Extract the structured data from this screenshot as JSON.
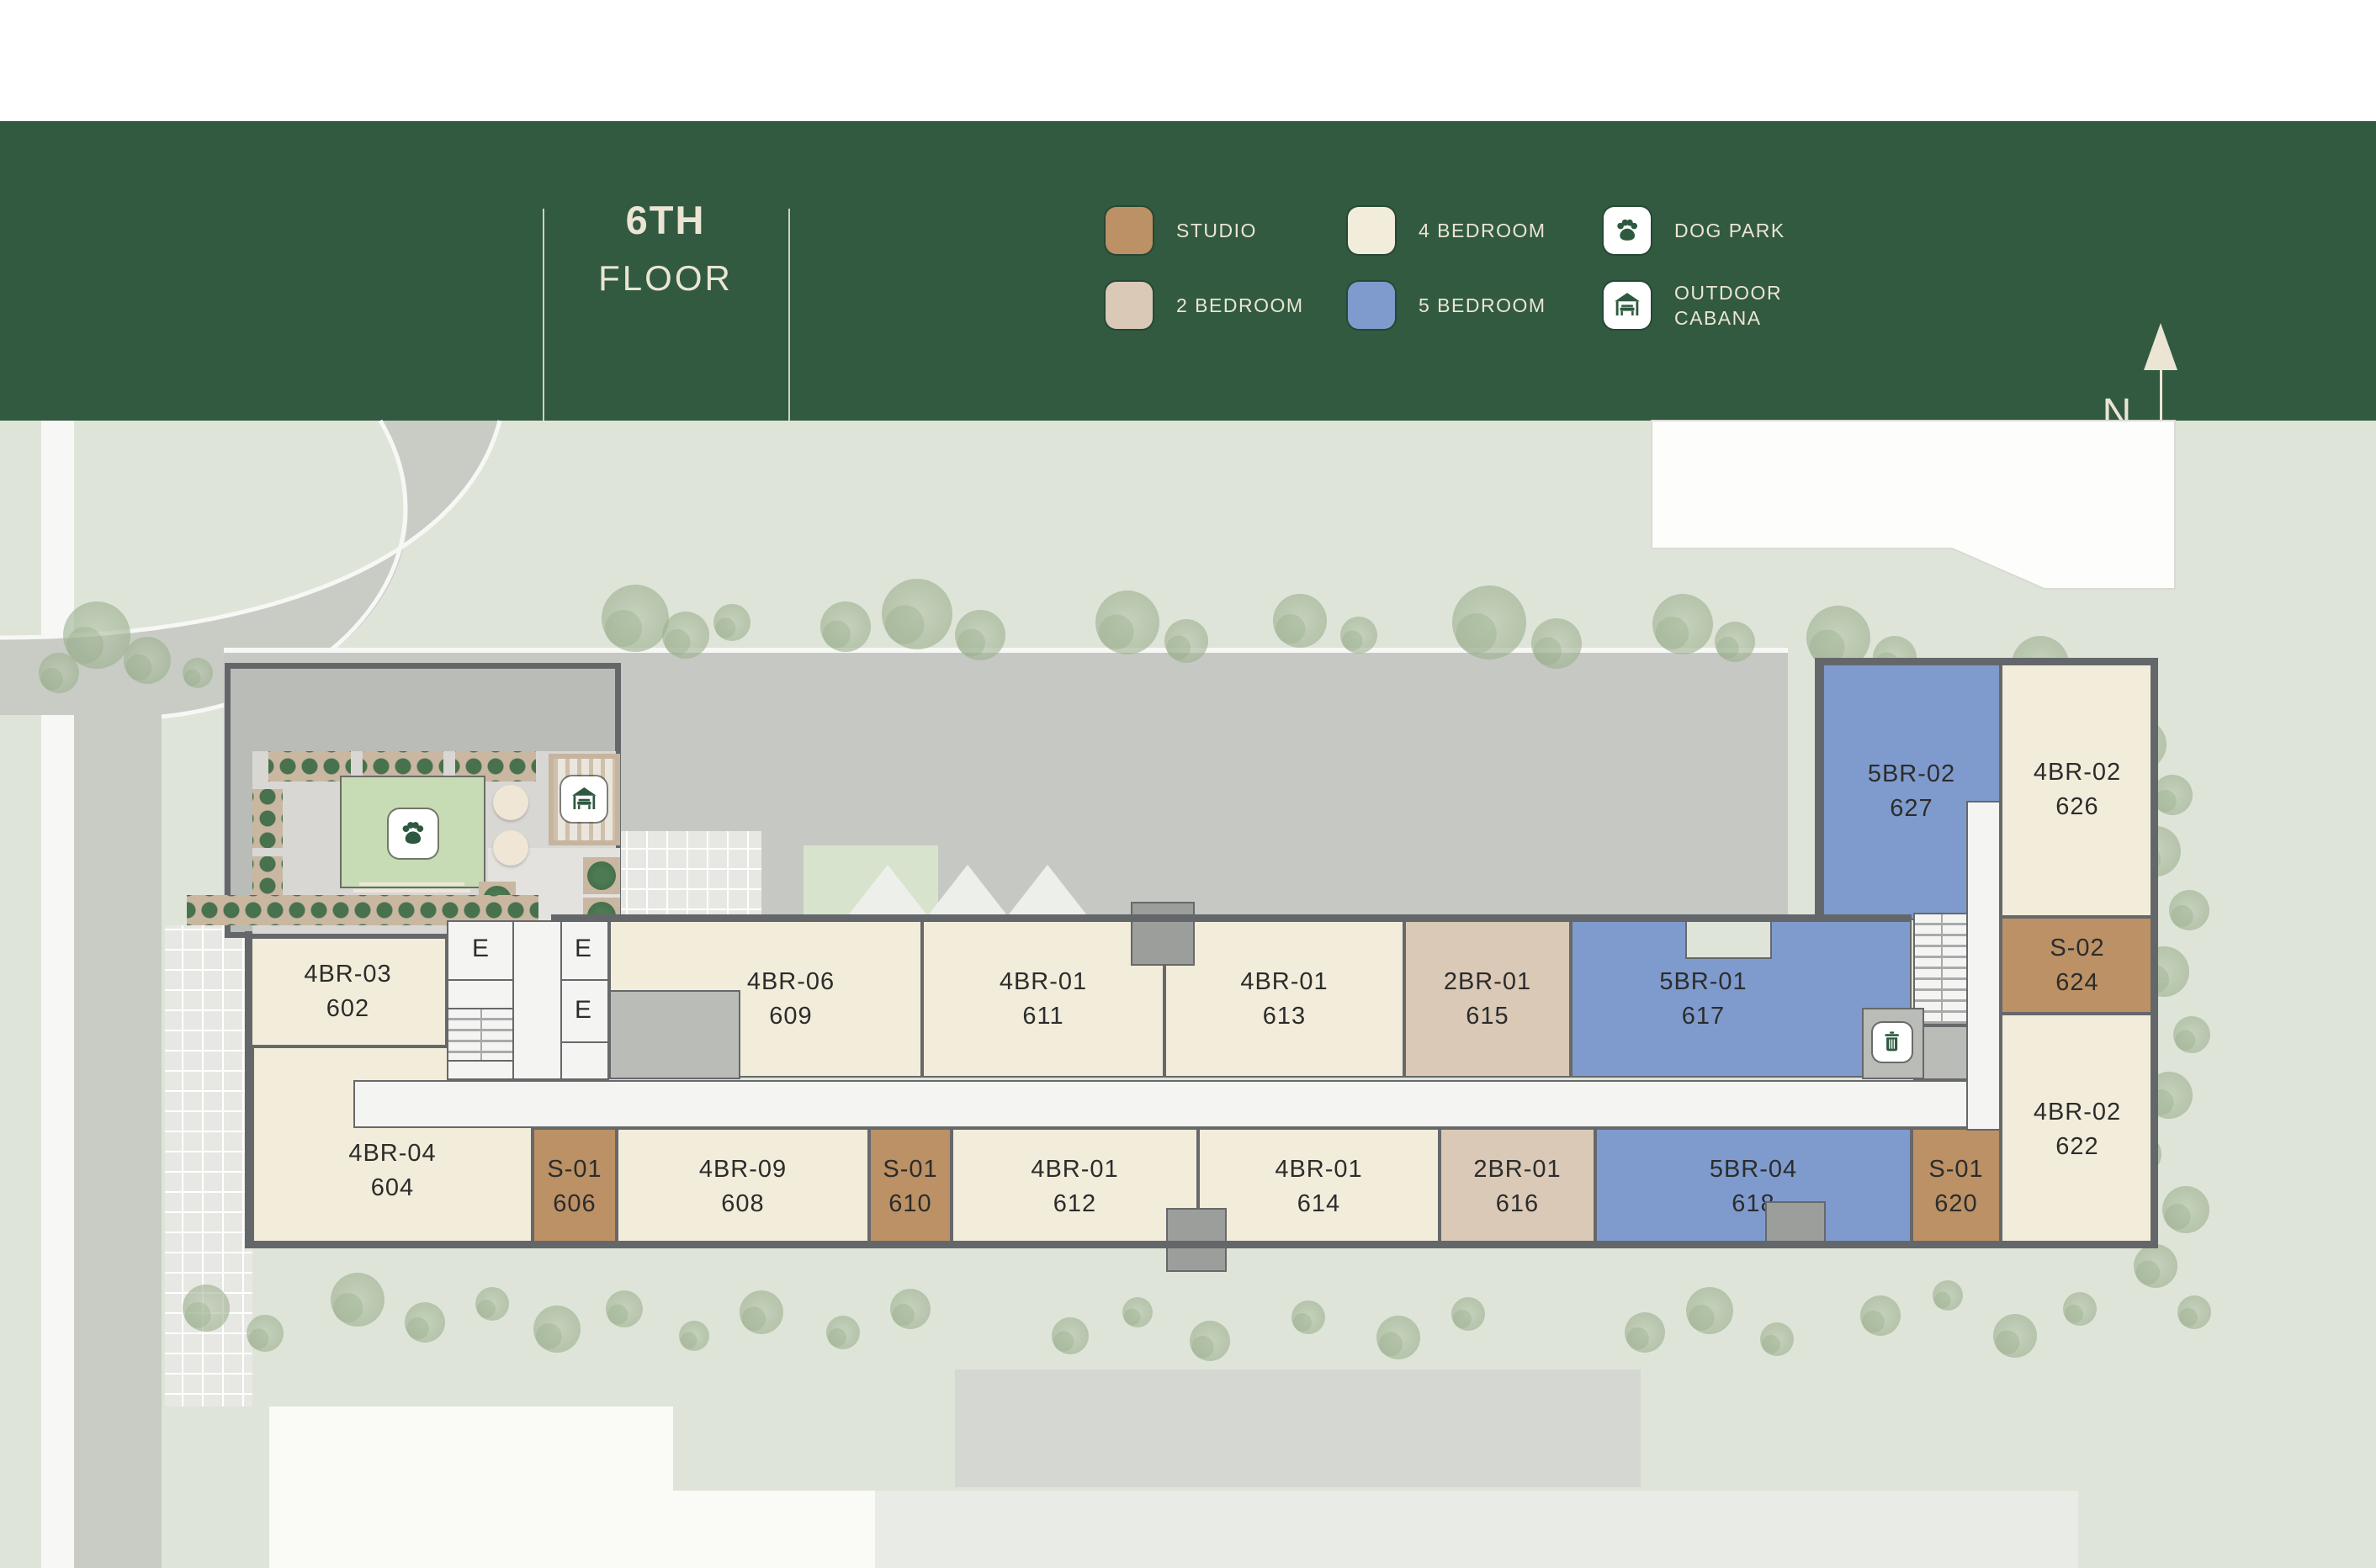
{
  "header": {
    "floor_number": "6TH",
    "floor_label": "FLOOR"
  },
  "legend": {
    "items": [
      {
        "label": "STUDIO",
        "color": "#bb9165",
        "icon": null
      },
      {
        "label": "2 BEDROOM",
        "color": "#dac9b6",
        "icon": null
      },
      {
        "label": "4 BEDROOM",
        "color": "#f2ecda",
        "icon": null
      },
      {
        "label": "5 BEDROOM",
        "color": "#7f9bcd",
        "icon": null
      },
      {
        "label": "DOG PARK",
        "color": "#ffffff",
        "icon": "paw-icon"
      },
      {
        "label": "OUTDOOR\nCABANA",
        "color": "#ffffff",
        "icon": "cabana-icon"
      }
    ]
  },
  "compass": {
    "label": "N"
  },
  "colors": {
    "studio": "#bb9165",
    "two_bed": "#dac9b6",
    "four_bed": "#f2ecda",
    "five_bed": "#7f9bcd",
    "header_green": "#315a41",
    "cream_text": "#ece5d3",
    "icon_green": "#2d5940"
  },
  "core": {
    "elevator_label": "E"
  },
  "amenities": {
    "dog_park_icon": "paw-icon",
    "cabana_icon": "cabana-icon",
    "trash_icon": "trash-icon"
  },
  "units": [
    {
      "name": "4BR-03",
      "number": "602",
      "type": "four_bed"
    },
    {
      "name": "4BR-04",
      "number": "604",
      "type": "four_bed"
    },
    {
      "name": "S-01",
      "number": "606",
      "type": "studio"
    },
    {
      "name": "4BR-09",
      "number": "608",
      "type": "four_bed"
    },
    {
      "name": "4BR-06",
      "number": "609",
      "type": "four_bed"
    },
    {
      "name": "S-01",
      "number": "610",
      "type": "studio"
    },
    {
      "name": "4BR-01",
      "number": "611",
      "type": "four_bed"
    },
    {
      "name": "4BR-01",
      "number": "612",
      "type": "four_bed"
    },
    {
      "name": "4BR-01",
      "number": "613",
      "type": "four_bed"
    },
    {
      "name": "4BR-01",
      "number": "614",
      "type": "four_bed"
    },
    {
      "name": "2BR-01",
      "number": "615",
      "type": "two_bed"
    },
    {
      "name": "2BR-01",
      "number": "616",
      "type": "two_bed"
    },
    {
      "name": "5BR-01",
      "number": "617",
      "type": "five_bed"
    },
    {
      "name": "5BR-04",
      "number": "618",
      "type": "five_bed"
    },
    {
      "name": "S-01",
      "number": "620",
      "type": "studio"
    },
    {
      "name": "4BR-02",
      "number": "622",
      "type": "four_bed"
    },
    {
      "name": "S-02",
      "number": "624",
      "type": "studio"
    },
    {
      "name": "4BR-02",
      "number": "626",
      "type": "four_bed"
    },
    {
      "name": "5BR-02",
      "number": "627",
      "type": "five_bed"
    }
  ]
}
